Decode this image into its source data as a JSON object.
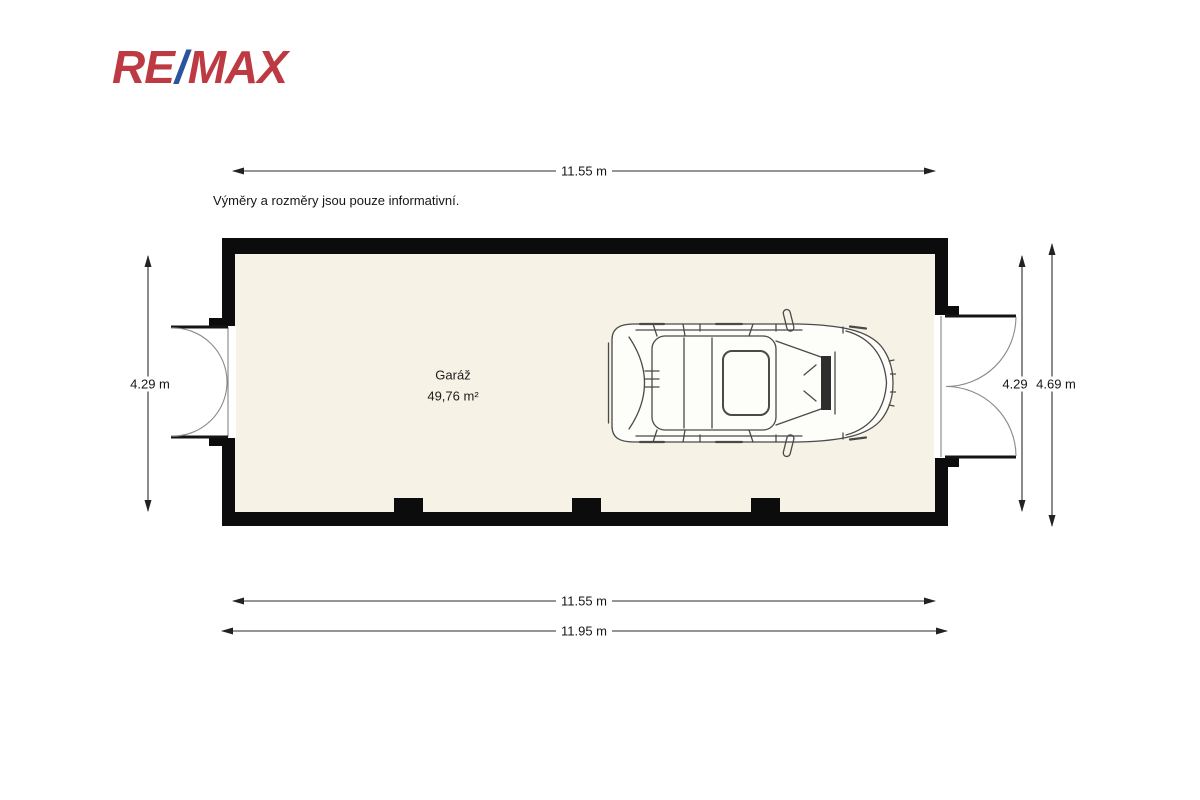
{
  "brand": {
    "logo_re": "RE",
    "logo_slash": "/",
    "logo_max": "MAX",
    "logo_red": "#be3a42",
    "logo_blue": "#2b549c"
  },
  "disclaimer": "Výměry a rozměry jsou pouze informativní.",
  "room": {
    "name": "Garáž",
    "area": "49,76 m²"
  },
  "dimensions": {
    "top_width": "11.55 m",
    "left_height": "4.29 m",
    "right_inner_height": "4.29",
    "right_outer_height": "4.69 m",
    "bottom_inner_width": "11.55 m",
    "bottom_outer_width": "11.95 m"
  },
  "colors": {
    "wall": "#0c0c0c",
    "floor": "#f6f3e6",
    "dimension_line": "#2b2b2b",
    "car_line": "#4a4a4a"
  },
  "icons": {
    "vehicle": "car-top-view"
  }
}
